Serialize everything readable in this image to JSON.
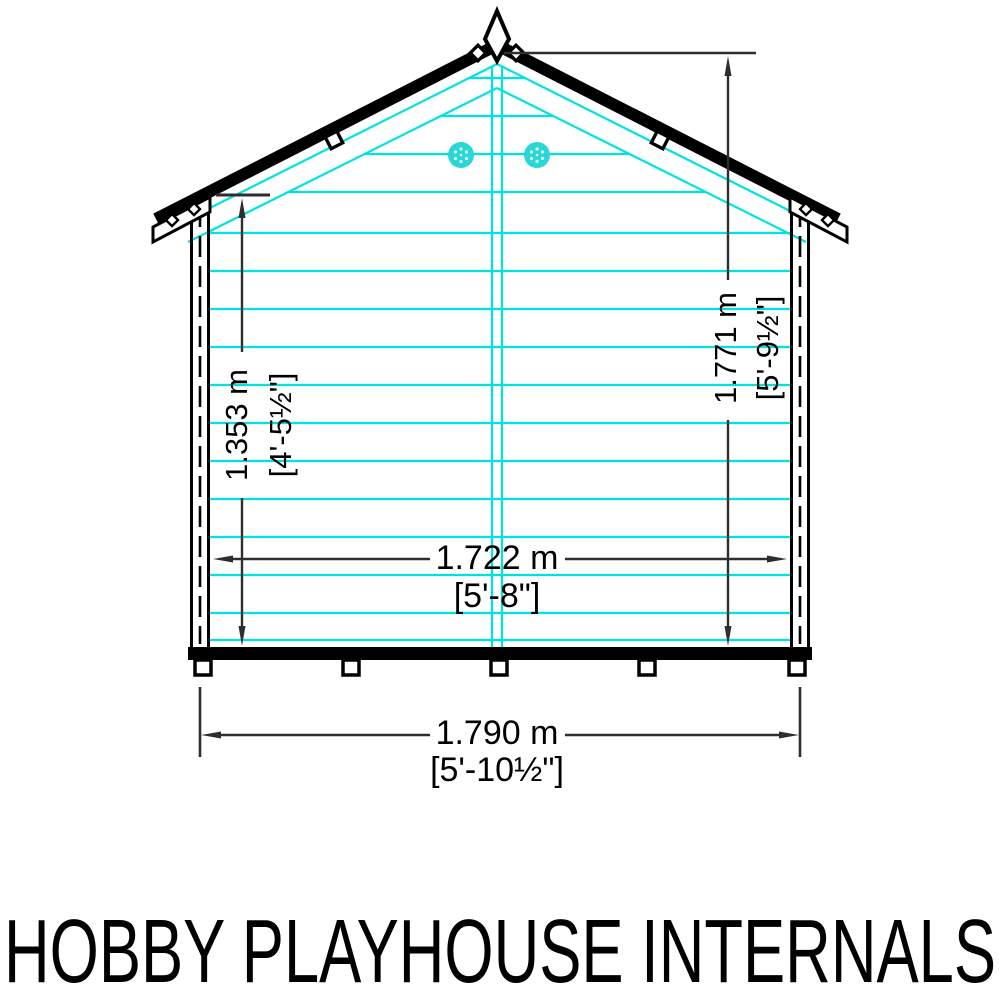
{
  "title": "HOBBY PLAYHOUSE INTERNALS",
  "colors": {
    "cladding": "#00e2e2",
    "vent_fill": "#2bd6d6",
    "outline": "#000000",
    "dim_line": "#2e2e2e"
  },
  "dimensions": {
    "wall_height": {
      "metric": "1.353 m",
      "imperial": "[4'-5½\"]"
    },
    "ridge_height": {
      "metric": "1.771 m",
      "imperial": "[5'-9½\"]"
    },
    "internal_width": {
      "metric": "1.722 m",
      "imperial": "[5'-8\"]"
    },
    "external_width": {
      "metric": "1.790 m",
      "imperial": "[5'-10½\"]"
    }
  }
}
